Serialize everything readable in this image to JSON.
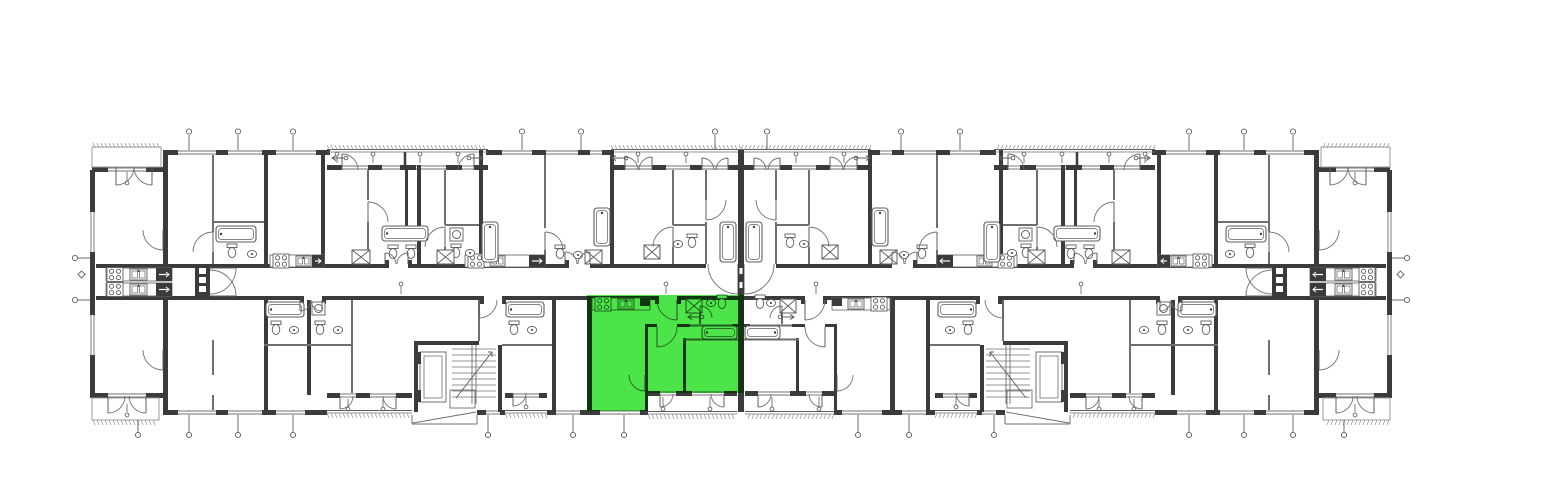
{
  "document": {
    "kind": "architectural floor plan",
    "description": "Black-and-white floor plan of a long multi-unit residential building with a central horizontal corridor; one two-room apartment just left of the building centre in the lower band is highlighted in bright green",
    "highlight": {
      "label": "highlighted apartment",
      "color": "#4de449",
      "location": "lower band, immediately left of the central party wall",
      "rooms": [
        "kitchen strip along corridor",
        "entry hall",
        "bathroom with tub, WC and basin",
        "living room",
        "bedroom",
        "second bedroom"
      ],
      "balcony_below_not_highlighted": true
    },
    "building": {
      "corridor": "single central horizontal corridor",
      "staircases": 2,
      "elevators": 2,
      "entrance_vestibules": 2,
      "balconies_top_edge": 5,
      "terraces_bottom_edge": 8,
      "kitchen_galleys_at_building_ends": 2,
      "symmetry": "mirror-symmetric about building centre"
    },
    "colors": {
      "background": "#ffffff",
      "walls": "#3b3b3b",
      "thin_lines": "#6f6f6f",
      "light_lines": "#9b9b9b",
      "highlight_green": "#4de449"
    }
  }
}
